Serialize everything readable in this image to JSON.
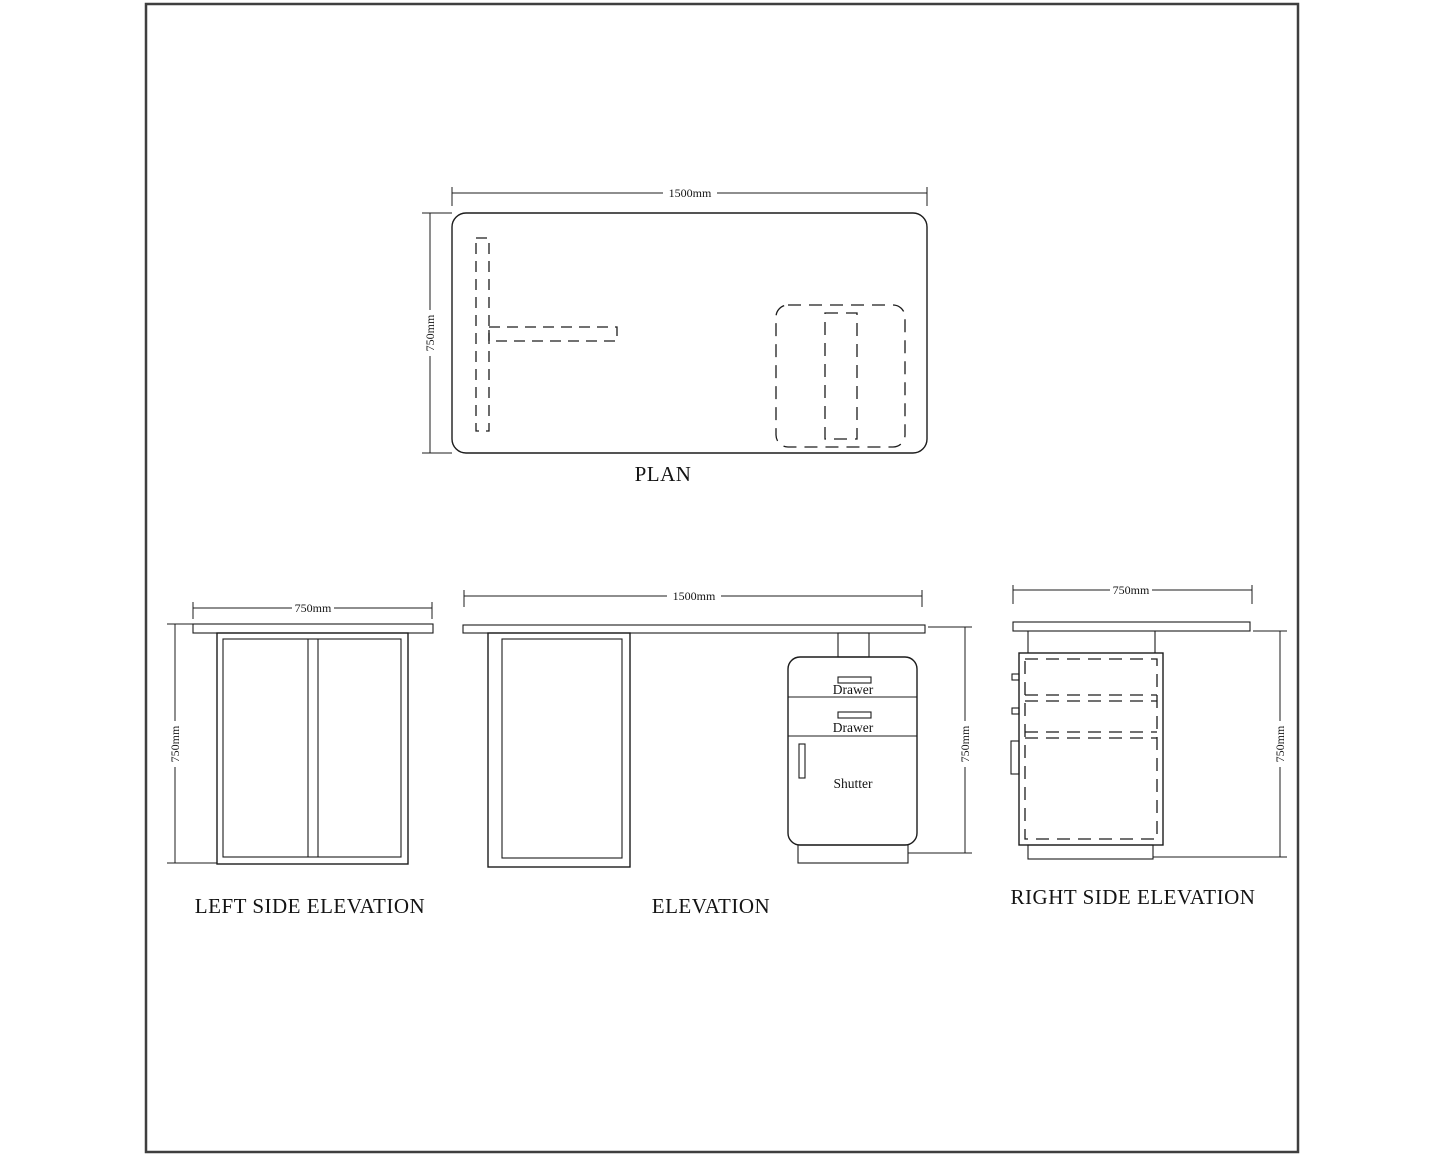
{
  "page": {
    "background": "#ffffff",
    "border_color": "#3f3f3f",
    "line_color": "#1c1c1c"
  },
  "plan": {
    "title": "PLAN",
    "width_dim": "1500mm",
    "depth_dim": "750mm"
  },
  "left_side_elevation": {
    "title": "LEFT SIDE ELEVATION",
    "width_dim": "750mm",
    "height_dim": "750mm"
  },
  "elevation": {
    "title": "ELEVATION",
    "width_dim": "1500mm",
    "height_dim": "750mm",
    "drawer_top_label": "Drawer",
    "drawer_middle_label": "Drawer",
    "shutter_label": "Shutter"
  },
  "right_side_elevation": {
    "title": "RIGHT SIDE ELEVATION",
    "width_dim": "750mm",
    "height_dim": "750mm"
  }
}
